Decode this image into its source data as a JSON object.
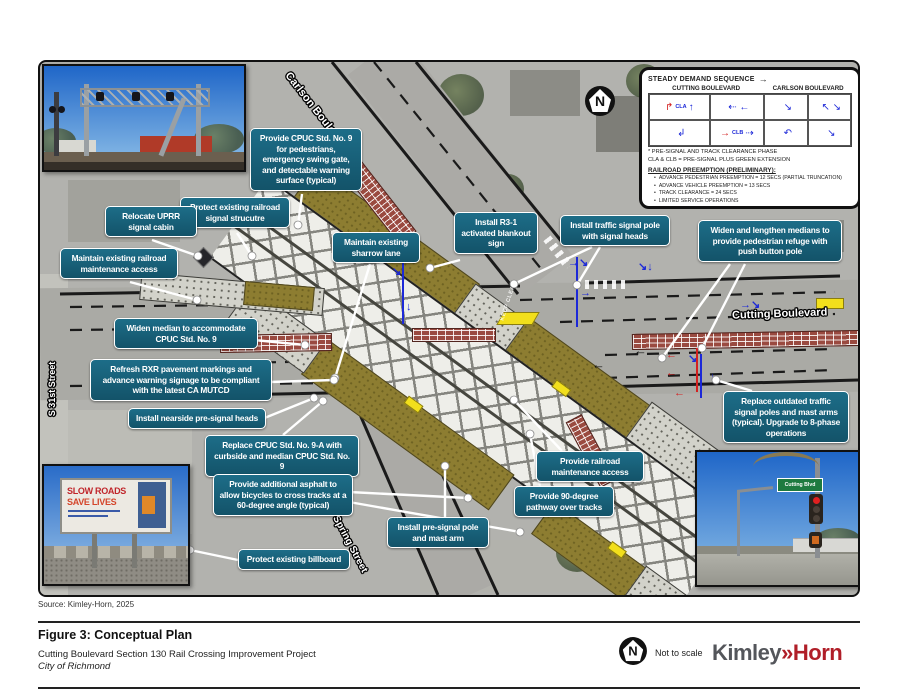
{
  "figure": {
    "source": "Source: Kimley-Horn, 2025",
    "title": "Figure 3: Conceptual Plan",
    "subtitle": "Cutting Boulevard Section 130 Rail Crossing Improvement Project",
    "client": "City of Richmond",
    "scale_note": "Not to scale",
    "logo": {
      "part1": "Kimley",
      "chevrons": "»",
      "part2": "Horn"
    }
  },
  "map": {
    "street_labels": {
      "carlson": "Carlson Boulevard",
      "cutting": "Cutting Boulevard",
      "spring": "Spring Street",
      "s31st": "S 31st Street"
    },
    "north_label": "N",
    "road_marking": "KEEP CLEAR"
  },
  "callouts": [
    {
      "id": "cpuc-std9-ped",
      "text": "Provide CPUC Std. No. 9 for pedestrians, emergency swing gate, and detectable warning surface (typical)"
    },
    {
      "id": "protect-signal-structure",
      "text": "Protect existing railroad signal strucutre"
    },
    {
      "id": "relocate-uprr-cabin",
      "text": "Relocate UPRR signal cabin"
    },
    {
      "id": "maintain-rr-maintenance-access",
      "text": "Maintain existing railroad maintenance access"
    },
    {
      "id": "maintain-sharrow-lane",
      "text": "Maintain existing sharrow lane"
    },
    {
      "id": "install-r3-1-blankout",
      "text": "Install R3-1 activated blankout sign"
    },
    {
      "id": "install-traffic-signal-pole",
      "text": "Install traffic signal pole with signal heads"
    },
    {
      "id": "widen-lengthen-medians",
      "text": "Widen and lengthen medians to provide pedestrian refuge with push button pole"
    },
    {
      "id": "widen-median-cpuc9",
      "text": "Widen median to accommodate CPUC Std. No. 9"
    },
    {
      "id": "refresh-rxr-markings",
      "text": "Refresh RXR pavement markings and advance warning signage to be compliant with the latest CA MUTCD"
    },
    {
      "id": "install-nearside-presignal",
      "text": "Install nearside pre-signal heads"
    },
    {
      "id": "replace-cpuc-9a",
      "text": "Replace CPUC Std. No. 9-A with curbside and median CPUC Std. No. 9"
    },
    {
      "id": "additional-asphalt-bicycles",
      "text": "Provide additional asphalt to allow bicycles to cross tracks at a 60-degree angle (typical)"
    },
    {
      "id": "protect-billboard",
      "text": "Protect existing billboard"
    },
    {
      "id": "install-presignal-pole",
      "text": "Install pre-signal pole and mast arm"
    },
    {
      "id": "provide-rr-maintenance-access",
      "text": "Provide railroad maintenance access"
    },
    {
      "id": "pathway-over-tracks",
      "text": "Provide 90-degree pathway over tracks"
    },
    {
      "id": "replace-outdated-poles",
      "text": "Replace outdated traffic signal poles and mast arms (typical). Upgrade to 8-phase operations"
    }
  ],
  "legend": {
    "title": "STEADY DEMAND SEQUENCE",
    "columns": [
      "CUTTING BOULEVARD",
      "CARLSON BOULEVARD"
    ],
    "cells": [
      {
        "red": "↱",
        "label": "CLA",
        "blue": "↑"
      },
      {
        "red": "",
        "label": "",
        "blue": "⇠ ←"
      },
      {
        "red": "",
        "label": "",
        "blue": "↘"
      },
      {
        "red": "",
        "label": "",
        "blue": "↖ ↘"
      },
      {
        "red": "",
        "label": "",
        "blue": "↲"
      },
      {
        "red": "→",
        "label": "CLB",
        "blue": "⇢"
      },
      {
        "red": "",
        "label": "",
        "blue": "↶"
      },
      {
        "red": "",
        "label": "",
        "blue": "↘"
      }
    ],
    "footnote1": "* PRE-SIGNAL AND TRACK CLEARANCE PHASE",
    "footnote2": "CLA & CLB = PRE-SIGNAL PLUS GREEN EXTENSION",
    "preemption_title": "RAILROAD PREEMPTION (PRELIMINARY):",
    "preemption_items": [
      "ADVANCE PEDESTRIAN PREEMPTION = 12 SECS (PARTIAL TRUNCATION)",
      "ADVANCE VEHICLE PREEMPTION = 13 SECS",
      "TRACK CLEARANCE = 24 SECS",
      "LIMITED SERVICE OPERATIONS"
    ]
  },
  "insets": {
    "billboard_line1": "SLOW ROADS",
    "billboard_line2": "SAVE LIVES",
    "street_sign": "Cutting Blvd"
  },
  "colors": {
    "callout_bg": "#15607A",
    "callout_border": "#FFFFFF",
    "arrow_blue": "#1C28D8",
    "arrow_red": "#D42020",
    "brick_median": "#9A4A40",
    "bike_asphalt": "#8D7D31",
    "highlight_yellow": "#F2DF1C",
    "logo_red": "#B01E28",
    "logo_gray": "#54565B"
  }
}
